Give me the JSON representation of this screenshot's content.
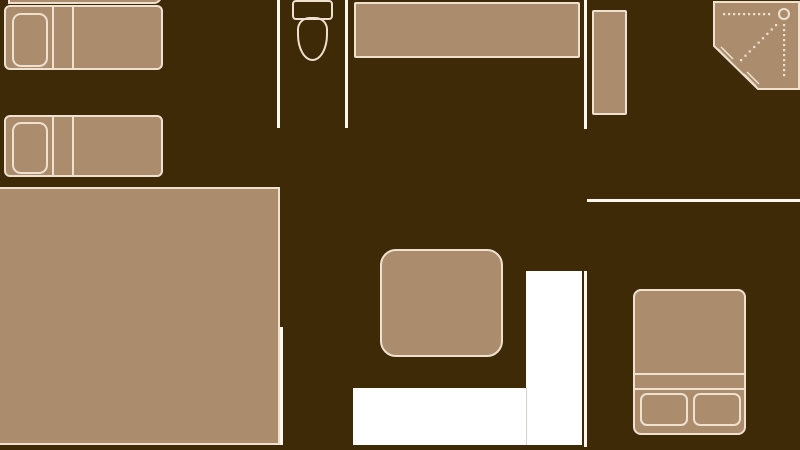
{
  "colors": {
    "background": "#3F2A07",
    "tan": "#AB8D6E",
    "cream": "#EEE1CF",
    "wallwhite": "#FCF7EF",
    "white": "#FFFFFF"
  },
  "floorplan": {
    "items": [
      {
        "name": "clipped-bed-edge",
        "kind": "furniture",
        "x": 8,
        "y": -10,
        "w": 154,
        "h": 14,
        "r": "0 0 8px 0"
      },
      {
        "name": "single-bed-1",
        "kind": "furniture",
        "x": 4,
        "y": 5,
        "w": 159,
        "h": 65,
        "r": "6px"
      },
      {
        "name": "single-bed-1-pillow",
        "kind": "outline",
        "x": 12,
        "y": 13,
        "w": 36,
        "h": 54,
        "r": "9px"
      },
      {
        "name": "single-bed-1-divider-a",
        "kind": "vline",
        "x": 52,
        "y": 5,
        "w": 2,
        "h": 65
      },
      {
        "name": "single-bed-1-divider-b",
        "kind": "vline",
        "x": 72,
        "y": 5,
        "w": 2,
        "h": 65
      },
      {
        "name": "single-bed-2",
        "kind": "furniture",
        "x": 4,
        "y": 115,
        "w": 159,
        "h": 62,
        "r": "6px"
      },
      {
        "name": "single-bed-2-pillow",
        "kind": "outline",
        "x": 12,
        "y": 122,
        "w": 36,
        "h": 52,
        "r": "9px"
      },
      {
        "name": "single-bed-2-divider-a",
        "kind": "vline",
        "x": 52,
        "y": 115,
        "w": 2,
        "h": 62
      },
      {
        "name": "single-bed-2-divider-b",
        "kind": "vline",
        "x": 72,
        "y": 115,
        "w": 2,
        "h": 62
      },
      {
        "name": "bathroom-wall-left",
        "kind": "wall",
        "x": 277,
        "y": 0,
        "w": 3,
        "h": 128
      },
      {
        "name": "bathroom-wall-right",
        "kind": "wall",
        "x": 345,
        "y": 0,
        "w": 3,
        "h": 128
      },
      {
        "name": "toilet-tank",
        "kind": "outline",
        "x": 292,
        "y": 0,
        "w": 41,
        "h": 20,
        "r": "4px"
      },
      {
        "name": "toilet-bowl",
        "kind": "outline",
        "x": 297,
        "y": 17,
        "w": 31,
        "h": 44,
        "r": "40% 40% 50% 50% / 28% 28% 60% 60%"
      },
      {
        "name": "countertop",
        "kind": "furniture",
        "x": 354,
        "y": 2,
        "w": 226,
        "h": 56,
        "r": "2px"
      },
      {
        "name": "hall-wall-top",
        "kind": "wall",
        "x": 584,
        "y": 0,
        "w": 3,
        "h": 129
      },
      {
        "name": "tall-cabinet",
        "kind": "furniture",
        "x": 592,
        "y": 10,
        "w": 35,
        "h": 105,
        "r": "2px"
      },
      {
        "name": "corner-shower",
        "kind": "shower",
        "x": 713,
        "y": 1,
        "w": 87,
        "h": 90,
        "details": {
          "outline_points": "1,1 86,1 86,88 45,88 1,45",
          "door_lines": [
            {
              "x1": 5,
              "y1": 48,
              "x2": 17,
              "y2": 60
            },
            {
              "x1": 8,
              "y1": 46,
              "x2": 20,
              "y2": 58
            },
            {
              "x1": 31,
              "y1": 73,
              "x2": 43,
              "y2": 85
            },
            {
              "x1": 34,
              "y1": 71,
              "x2": 46,
              "y2": 83
            }
          ],
          "dot_runs": [
            {
              "x1": 11,
              "y1": 13,
              "x2": 56,
              "y2": 13,
              "count": 10
            },
            {
              "x1": 71,
              "y1": 24,
              "x2": 71,
              "y2": 74,
              "count": 11
            },
            {
              "x1": 63,
              "y1": 24,
              "x2": 28,
              "y2": 59,
              "count": 9
            }
          ],
          "circle": {
            "cx": 71,
            "cy": 13,
            "r": 5
          }
        }
      },
      {
        "name": "large-rug",
        "kind": "furniture",
        "x": -2,
        "y": 187,
        "w": 282,
        "h": 258,
        "r": "0"
      },
      {
        "name": "rug-side-wall",
        "kind": "wall",
        "x": 280,
        "y": 327,
        "w": 3,
        "h": 118
      },
      {
        "name": "center-table",
        "kind": "furniture",
        "x": 380,
        "y": 249,
        "w": 123,
        "h": 108,
        "r": "16px"
      },
      {
        "name": "entry-area-vertical",
        "kind": "white",
        "x": 526,
        "y": 271,
        "w": 56,
        "h": 174
      },
      {
        "name": "entry-area-horizontal",
        "kind": "white",
        "x": 353,
        "y": 388,
        "w": 229,
        "h": 57
      },
      {
        "name": "entry-area-seam",
        "kind": "seam",
        "x": 526,
        "y": 388,
        "w": 1,
        "h": 57
      },
      {
        "name": "hall-wall-mid",
        "kind": "wall",
        "x": 584,
        "y": 271,
        "w": 3,
        "h": 176
      },
      {
        "name": "bedroom-wall-horizontal",
        "kind": "wall",
        "x": 587,
        "y": 199,
        "w": 213,
        "h": 3
      },
      {
        "name": "double-bed",
        "kind": "furniture",
        "x": 633,
        "y": 289,
        "w": 113,
        "h": 146,
        "r": "8px"
      },
      {
        "name": "double-bed-fold-line-a",
        "kind": "hline",
        "x": 635,
        "y": 373,
        "w": 109,
        "h": 2
      },
      {
        "name": "double-bed-fold-line-b",
        "kind": "hline",
        "x": 635,
        "y": 388,
        "w": 109,
        "h": 2
      },
      {
        "name": "double-bed-pillow-left",
        "kind": "outline",
        "x": 640,
        "y": 393,
        "w": 48,
        "h": 33,
        "r": "7px"
      },
      {
        "name": "double-bed-pillow-right",
        "kind": "outline",
        "x": 693,
        "y": 393,
        "w": 48,
        "h": 33,
        "r": "7px"
      }
    ]
  }
}
